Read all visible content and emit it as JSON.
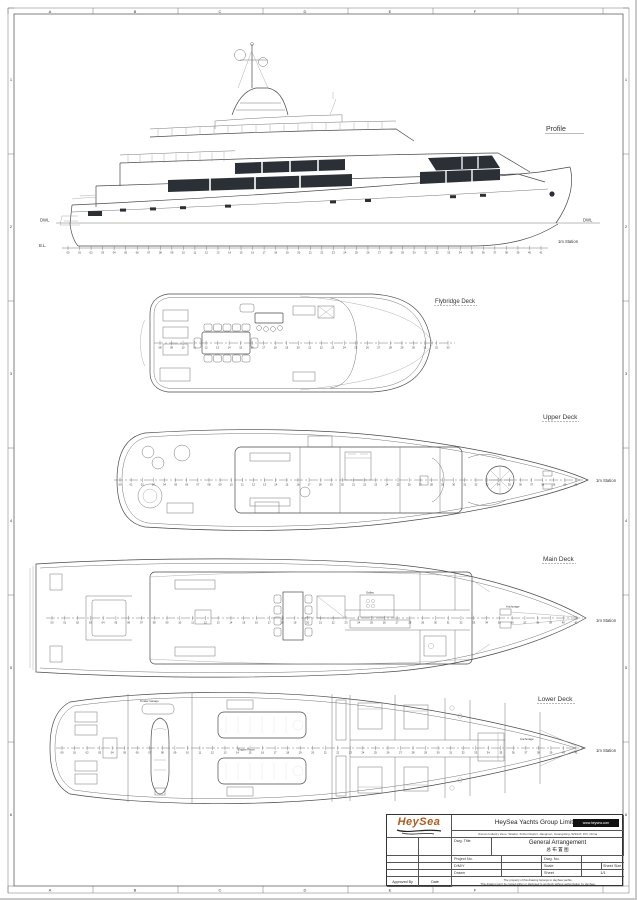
{
  "colors": {
    "line": "#4a4a4a",
    "window": "#2b3036",
    "engine": "#5f6f58",
    "logo_orange": "#b05a1a",
    "badge_bg": "#111111"
  },
  "border": {
    "top_letters": [
      "A",
      "B",
      "C",
      "D",
      "E",
      "F"
    ],
    "bottom_letters": [
      "A",
      "B",
      "C",
      "D",
      "E",
      "F"
    ],
    "left_numbers": [
      "1",
      "2",
      "3",
      "4",
      "5",
      "6"
    ],
    "right_numbers": [
      "1",
      "2",
      "3",
      "4",
      "5",
      "6"
    ]
  },
  "profile": {
    "title": "Profile",
    "dwl_left": "DWL",
    "dwl_right": "DWL",
    "baseline_label": "B.L.",
    "station_label": "1m Station"
  },
  "decks": {
    "flybridge": {
      "title": "Flybridge Deck"
    },
    "upper": {
      "title": "Upper Deck",
      "station_label": "1m Station"
    },
    "main": {
      "title": "Main Deck",
      "station_label": "1m Station",
      "galley": "Galley",
      "anchorage": "Anchorage"
    },
    "lower": {
      "title": "Lower Deck",
      "station_label": "1m Station",
      "tender_garage": "Tender Garage",
      "engine_room": "Engine Room",
      "anchorage": "Anchorage"
    }
  },
  "stations": {
    "rows": {
      "profile": {
        "start": 0,
        "end": 41
      },
      "flybridge": {
        "start": 8,
        "end": 33
      },
      "upper": {
        "start": 0,
        "end": 41
      },
      "main": {
        "start": 0,
        "end": 41
      },
      "lower": {
        "start": 0,
        "end": 41
      }
    }
  },
  "title_block": {
    "logo": "HeySea",
    "company": "HeySea Yachts Group Limited",
    "website": "www.heysea.com",
    "address": "Jinman Industry Zone, Shadui, Xinhui District, Jiangmen, Guangdong, 529147, P.R. China",
    "dwg_title_label": "Dwg. Title",
    "dwg_title": "General Arrangement",
    "dwg_title_cn": "总 布 置 图",
    "project_no_label": "Project No.",
    "dwg_no_label": "Dwg. No.",
    "dmy_label": "D/M/Y",
    "scale_label": "Scale",
    "sheet_size_label": "Sheet Size",
    "drawn_label": "Drawn",
    "sheet_label": "Sheet",
    "sheet_value": "1/1",
    "approved_by_label": "Approved By",
    "date_label": "Date",
    "copyright_line1": "The property of this drawing belongs to HeySea yachts.",
    "copyright_line2": "This drawing can't be copied either or disclosed to anybody without authorization by HeySea."
  }
}
